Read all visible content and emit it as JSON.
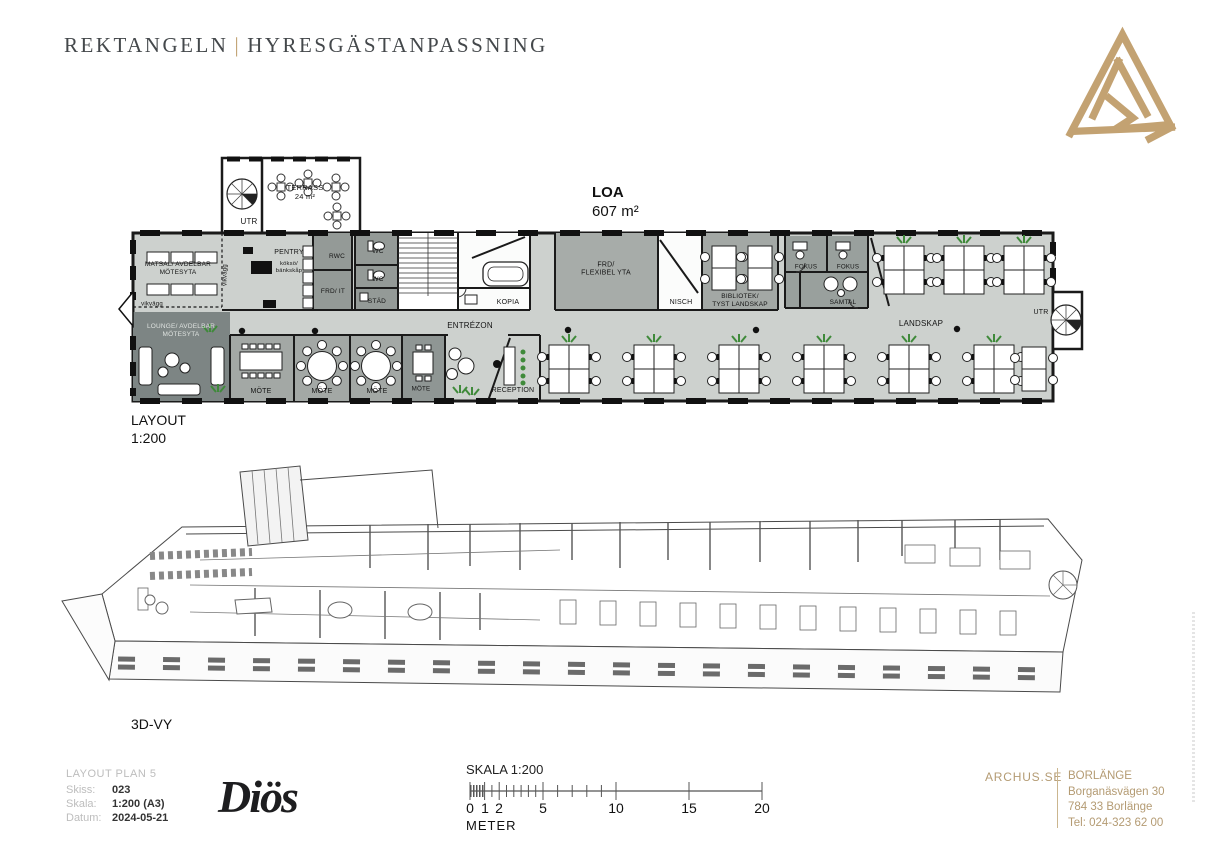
{
  "header": {
    "title_left": "REKTANGELN",
    "title_separator": "|",
    "title_right": "HYRESGÄSTANPASSNING",
    "logo_icon": "archus-triangle-logo"
  },
  "plan2d": {
    "area_label": "LOA",
    "area_value": "607 m²",
    "caption": "LAYOUT\n1:200",
    "rooms": {
      "terrass": "TERRASS\n24 m²",
      "utr_top": "UTR",
      "vikvagg_vertical": "vikvägg",
      "vikvagg_horizontal": "vikvägg",
      "matsal": "MATSAL/ AVDELBAR\nMÖTESYTA",
      "pentry": "PENTRY",
      "pentry_sub": "köksö/\nbänkskåp",
      "rwc": "RWC",
      "frd_it": "FRD/ IT",
      "wc_1": "WC",
      "wc_2": "WC",
      "stad": "STÄD",
      "kopia": "KOPIA",
      "entrezon": "ENTRÉZON",
      "frd_flexibel": "FRD/\nFLEXIBEL YTA",
      "nisch": "NISCH",
      "bibliotek": "BIBLIOTEK/\nTYST LANDSKAP",
      "fokus_1": "FOKUS",
      "fokus_2": "FOKUS",
      "samtal": "SAMTAL",
      "landskap": "LANDSKAP",
      "utr_right": "UTR",
      "lounge": "LOUNGE/ AVDELBAR\nMÖTESYTA",
      "mote_1": "MÖTE",
      "mote_2": "MÖTE",
      "mote_3": "MÖTE",
      "mote_4": "MÖTE",
      "reception": "RECEPTION"
    }
  },
  "plan3d": {
    "caption": "3D-VY"
  },
  "footer": {
    "doc": {
      "title": "LAYOUT PLAN 5",
      "rows": [
        {
          "label": "Skiss:",
          "value": "023"
        },
        {
          "label": "Skala:",
          "value": "1:200 (A3)"
        },
        {
          "label": "Datum:",
          "value": "2024-05-21"
        }
      ]
    },
    "brand_logo": "Diös",
    "scale_bar": {
      "title": "SKALA 1:200",
      "tick_labels": [
        "0",
        "1",
        "2",
        "5",
        "10",
        "15",
        "20"
      ],
      "unit": "METER"
    },
    "contact": {
      "site": "ARCHUS.SE",
      "office": "BORLÄNGE",
      "address_line1": "Borganäsvägen 30",
      "address_line2": "784 33 Borlänge",
      "phone": "Tel: 024-323 62 00"
    }
  },
  "colors": {
    "accent_gold": "#bfa06f",
    "wall_black": "#1a1a1a",
    "floor_gray": "#cdd1ce",
    "room_gray": "#a3a8a5",
    "room_dark_gray": "#949a97",
    "lounge_gray": "#7d8584",
    "plant_green": "#3f8a3a"
  }
}
